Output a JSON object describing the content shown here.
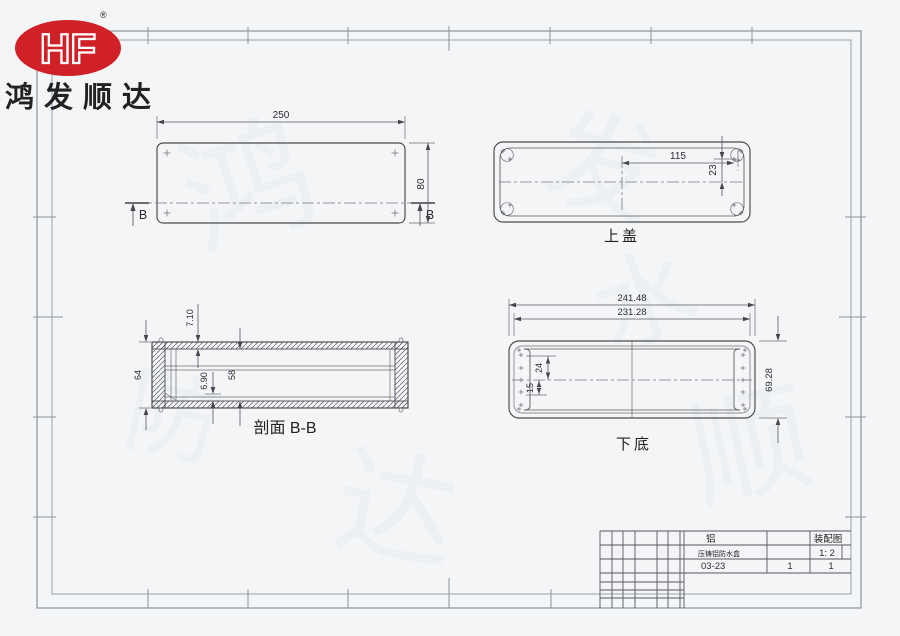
{
  "logo": {
    "monogram": "HF",
    "registered": "®",
    "company": "鸿发顺达"
  },
  "views": {
    "top_view": {
      "width": "250",
      "height": "80",
      "section_left": "B",
      "section_right": "B"
    },
    "top_cover": {
      "label": "上盖",
      "hole_offset_x": "115",
      "hole_offset_y": "23"
    },
    "section_bb": {
      "label": "剖面 B-B",
      "wall_thickness": "7.10",
      "outer_height": "64",
      "pocket_depth": "6.90",
      "inner_height": "58"
    },
    "bottom_base": {
      "label": "下底",
      "outer_width": "241.48",
      "hole_span": "231.28",
      "hole_top": "24",
      "hole_bottom": "15",
      "outer_height": "69.28"
    }
  },
  "title_block": {
    "material": "铝",
    "drawing_type": "装配图",
    "product_name": "压铸铝防水盒",
    "scale": "1: 2",
    "drawing_code": "03-23",
    "sheet": "1",
    "sheets_total": "1"
  },
  "colors": {
    "brand_red": "#cf2127",
    "line": "#4a4a4d",
    "paper": "#f4f5f7",
    "frame": "#8d939b"
  }
}
